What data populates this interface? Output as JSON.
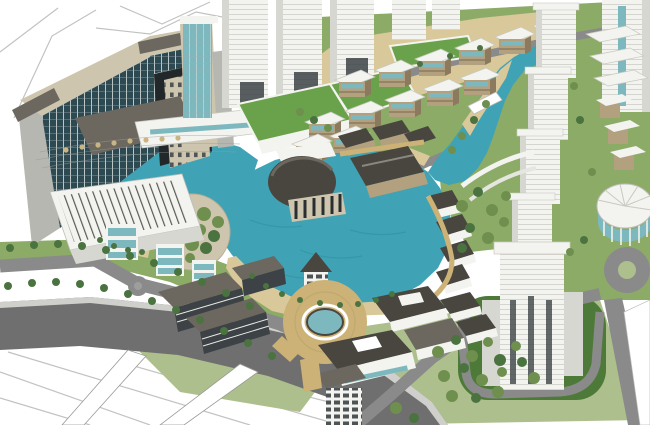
{
  "title": "aerial-3d-masterplan-rendering",
  "palette": {
    "paper": "#ffffff",
    "sketch": "#b3b3b0",
    "water": "#3fa3b5",
    "water_dark": "#2e8ea2",
    "sand": "#d8c89a",
    "paving": "#ccb277",
    "road_dark": "#6f6f6f",
    "road_mid": "#8a8a8a",
    "road_light": "#9e9e9c",
    "curb": "#cfcfcc",
    "lawn_light": "#adbf8d",
    "lawn_mid": "#8cab67",
    "lawn_dark": "#4e7a39",
    "green_roof": "#6aa24b",
    "tree_olive": "#6f8f4f",
    "tree_dark": "#4b7340",
    "bldg_white": "#f3f3ef",
    "bldg_shade": "#d7d7d1",
    "bldg_gray": "#b7b7b1",
    "facade_dark": "#3c4245",
    "glass_teal": "#7db8be",
    "glass_dark": "#2d4a52",
    "beige": "#cec5ae",
    "tan_wall": "#b3a07e",
    "tan_dark": "#8c7a5e",
    "roof_dark": "#49463f",
    "roof_mid": "#6c675f",
    "arch_void": "#22272a"
  },
  "scene": {
    "description": "SketchUp-style aerial rendering of a lakeside mixed-use development",
    "regions": [
      "hotel-slab",
      "central-lake",
      "village-cluster",
      "terraced-villas",
      "tower-row",
      "plaza-fountain",
      "ring-roads"
    ]
  }
}
